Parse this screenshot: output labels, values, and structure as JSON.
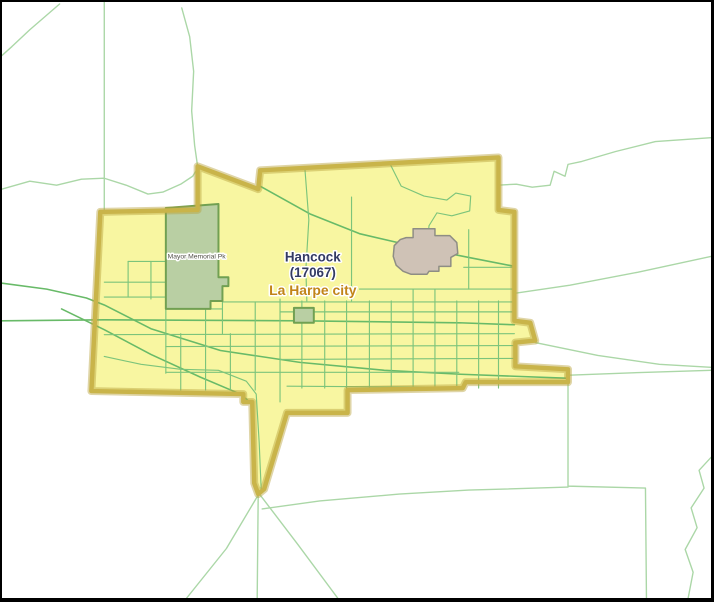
{
  "window": {
    "width": 714,
    "height": 602,
    "frame_color": "#000000",
    "background_color": "#ffffff"
  },
  "map": {
    "colors": {
      "city_fill": "#f8f6a1",
      "city_border": "#c9b44a",
      "city_border_glow": "#b7a13c",
      "rural_road": "#abd7a7",
      "major_road": "#68ba68",
      "city_street": "#7cc47b",
      "park_fill": "#b9cfa3",
      "park_stroke": "#71a052",
      "landmark_fill": "#cfc2b6",
      "landmark_stroke": "#8e8d84"
    },
    "city_boundary": {
      "name": "la-harpe-city-boundary",
      "stroke_width": 4.5,
      "glow_width": 8,
      "points": [
        [
          197,
          166
        ],
        [
          258,
          189
        ],
        [
          260,
          170
        ],
        [
          500,
          157
        ],
        [
          500,
          210
        ],
        [
          516,
          212
        ],
        [
          516,
          322
        ],
        [
          532,
          324
        ],
        [
          537,
          342
        ],
        [
          517,
          344
        ],
        [
          517,
          368
        ],
        [
          570,
          371
        ],
        [
          570,
          384
        ],
        [
          467,
          384
        ],
        [
          464,
          390
        ],
        [
          348,
          392
        ],
        [
          348,
          415
        ],
        [
          287,
          415
        ],
        [
          264,
          492
        ],
        [
          258,
          497
        ],
        [
          254,
          486
        ],
        [
          252,
          404
        ],
        [
          243,
          404
        ],
        [
          243,
          396
        ],
        [
          90,
          393
        ],
        [
          99,
          212
        ],
        [
          197,
          210
        ]
      ]
    },
    "parks": [
      {
        "name": "mayor-memorial-park",
        "points": [
          [
            165,
            208
          ],
          [
            218,
            204
          ],
          [
            218,
            278
          ],
          [
            228,
            278
          ],
          [
            228,
            287
          ],
          [
            222,
            287
          ],
          [
            222,
            302
          ],
          [
            210,
            302
          ],
          [
            210,
            310
          ],
          [
            165,
            310
          ]
        ]
      },
      {
        "name": "small-park",
        "points": [
          [
            294,
            309
          ],
          [
            314,
            309
          ],
          [
            314,
            324
          ],
          [
            294,
            324
          ]
        ]
      }
    ],
    "landmark": {
      "name": "landmark-area",
      "points": [
        [
          407,
          238
        ],
        [
          414,
          238
        ],
        [
          414,
          229
        ],
        [
          436,
          229
        ],
        [
          436,
          236
        ],
        [
          451,
          236
        ],
        [
          458,
          243
        ],
        [
          459,
          254
        ],
        [
          452,
          258
        ],
        [
          452,
          267
        ],
        [
          440,
          267
        ],
        [
          440,
          272
        ],
        [
          430,
          272
        ],
        [
          428,
          275
        ],
        [
          412,
          275
        ],
        [
          404,
          272
        ],
        [
          397,
          266
        ],
        [
          394,
          257
        ],
        [
          395,
          246
        ],
        [
          401,
          240
        ]
      ]
    },
    "rural_roads": {
      "width": 1.4,
      "lines": [
        [
          [
            103,
            0
          ],
          [
            103,
            211
          ]
        ],
        [
          [
            58,
            2
          ],
          [
            28,
            28
          ],
          [
            10,
            45
          ],
          [
            0,
            54
          ]
        ],
        [
          [
            181,
            6
          ],
          [
            189,
            35
          ],
          [
            193,
            70
          ],
          [
            191,
            110
          ],
          [
            194,
            145
          ],
          [
            197,
            166
          ]
        ],
        [
          [
            0,
            189
          ],
          [
            28,
            181
          ],
          [
            55,
            185
          ],
          [
            80,
            179
          ],
          [
            103,
            178
          ],
          [
            125,
            185
          ],
          [
            147,
            194
          ],
          [
            162,
            192
          ],
          [
            180,
            184
          ],
          [
            192,
            176
          ],
          [
            197,
            168
          ]
        ],
        [
          [
            714,
            137
          ],
          [
            658,
            141
          ],
          [
            618,
            151
          ],
          [
            584,
            161
          ],
          [
            570,
            164
          ],
          [
            567,
            176
          ],
          [
            556,
            171
          ],
          [
            552,
            185
          ],
          [
            534,
            187
          ],
          [
            518,
            184
          ],
          [
            499,
            185
          ]
        ],
        [
          [
            714,
            257
          ],
          [
            640,
            273
          ],
          [
            572,
            286
          ],
          [
            518,
            294
          ]
        ],
        [
          [
            537,
            344
          ],
          [
            600,
            357
          ],
          [
            662,
            366
          ],
          [
            714,
            369
          ]
        ],
        [
          [
            571,
            377
          ],
          [
            650,
            374
          ],
          [
            714,
            372
          ]
        ],
        [
          [
            570,
            385
          ],
          [
            570,
            489
          ],
          [
            648,
            491
          ],
          [
            649,
            602
          ]
        ],
        [
          [
            262,
            512
          ],
          [
            320,
            504
          ],
          [
            400,
            497
          ],
          [
            470,
            493
          ],
          [
            570,
            490
          ]
        ],
        [
          [
            714,
            460
          ],
          [
            702,
            473
          ],
          [
            707,
            491
          ],
          [
            694,
            511
          ],
          [
            700,
            531
          ],
          [
            688,
            553
          ],
          [
            696,
            576
          ],
          [
            691,
            602
          ]
        ],
        [
          [
            258,
            498
          ],
          [
            257,
            602
          ]
        ],
        [
          [
            258,
            498
          ],
          [
            226,
            552
          ],
          [
            186,
            602
          ]
        ],
        [
          [
            260,
            498
          ],
          [
            298,
            548
          ],
          [
            338,
            602
          ]
        ]
      ]
    },
    "major_roads": {
      "width": 1.6,
      "lines": [
        [
          [
            0,
            322
          ],
          [
            103,
            321
          ],
          [
            300,
            322
          ],
          [
            460,
            324
          ],
          [
            516,
            326
          ]
        ],
        [
          [
            0,
            284
          ],
          [
            45,
            290
          ],
          [
            85,
            299
          ],
          [
            103,
            306
          ],
          [
            150,
            330
          ],
          [
            220,
            352
          ],
          [
            300,
            364
          ],
          [
            385,
            372
          ],
          [
            462,
            376
          ],
          [
            516,
            378
          ],
          [
            568,
            380
          ]
        ],
        [
          [
            60,
            310
          ],
          [
            103,
            331
          ],
          [
            150,
            356
          ],
          [
            200,
            379
          ],
          [
            240,
            396
          ],
          [
            252,
            406
          ]
        ],
        [
          [
            260,
            186
          ],
          [
            310,
            214
          ],
          [
            360,
            234
          ],
          [
            420,
            248
          ],
          [
            470,
            258
          ],
          [
            516,
            267
          ]
        ]
      ]
    },
    "city_streets": {
      "width": 1.15,
      "lines": [
        [
          [
            103,
            358
          ],
          [
            140,
            366
          ],
          [
            180,
            371
          ],
          [
            218,
            372
          ],
          [
            246,
            383
          ],
          [
            256,
            396
          ],
          [
            259,
            445
          ],
          [
            261,
            492
          ]
        ],
        [
          [
            222,
            303
          ],
          [
            516,
            303
          ]
        ],
        [
          [
            280,
            313
          ],
          [
            516,
            313
          ]
        ],
        [
          [
            103,
            336
          ],
          [
            516,
            335
          ]
        ],
        [
          [
            165,
            348
          ],
          [
            516,
            347
          ]
        ],
        [
          [
            280,
            361
          ],
          [
            516,
            360
          ]
        ],
        [
          [
            165,
            374
          ],
          [
            460,
            374
          ]
        ],
        [
          [
            287,
            388
          ],
          [
            435,
            389
          ]
        ],
        [
          [
            360,
            290
          ],
          [
            516,
            290
          ]
        ],
        [
          [
            465,
            268
          ],
          [
            516,
            268
          ]
        ],
        [
          [
            470,
            230
          ],
          [
            470,
            290
          ]
        ],
        [
          [
            305,
            168
          ],
          [
            309,
            220
          ],
          [
            306,
            270
          ],
          [
            307,
            302
          ]
        ],
        [
          [
            352,
            197
          ],
          [
            352,
            302
          ]
        ],
        [
          [
            390,
            162
          ],
          [
            402,
            186
          ],
          [
            425,
            196
          ],
          [
            448,
            200
          ],
          [
            457,
            193
          ],
          [
            472,
            196
          ],
          [
            471,
            211
          ],
          [
            453,
            216
          ],
          [
            438,
            213
          ],
          [
            430,
            226
          ],
          [
            428,
            250
          ],
          [
            430,
            268
          ]
        ],
        [
          [
            205,
            303
          ],
          [
            205,
            392
          ]
        ],
        [
          [
            230,
            335
          ],
          [
            230,
            392
          ]
        ],
        [
          [
            255,
            303
          ],
          [
            255,
            392
          ]
        ],
        [
          [
            280,
            300
          ],
          [
            280,
            404
          ]
        ],
        [
          [
            302,
            302
          ],
          [
            302,
            390
          ]
        ],
        [
          [
            325,
            302
          ],
          [
            325,
            390
          ]
        ],
        [
          [
            347,
            302
          ],
          [
            347,
            392
          ]
        ],
        [
          [
            370,
            302
          ],
          [
            370,
            390
          ]
        ],
        [
          [
            392,
            302
          ],
          [
            392,
            390
          ]
        ],
        [
          [
            414,
            290
          ],
          [
            414,
            390
          ]
        ],
        [
          [
            436,
            290
          ],
          [
            436,
            390
          ]
        ],
        [
          [
            458,
            302
          ],
          [
            458,
            390
          ]
        ],
        [
          [
            480,
            302
          ],
          [
            480,
            390
          ]
        ],
        [
          [
            500,
            302
          ],
          [
            500,
            390
          ]
        ],
        [
          [
            165,
            310
          ],
          [
            165,
            375
          ]
        ],
        [
          [
            180,
            335
          ],
          [
            180,
            392
          ]
        ],
        [
          [
            127,
            262
          ],
          [
            165,
            262
          ]
        ],
        [
          [
            127,
            262
          ],
          [
            127,
            298
          ]
        ],
        [
          [
            150,
            262
          ],
          [
            150,
            300
          ]
        ],
        [
          [
            103,
            283
          ],
          [
            165,
            283
          ]
        ],
        [
          [
            103,
            298
          ],
          [
            165,
            298
          ]
        ],
        [
          [
            165,
            310
          ],
          [
            222,
            310
          ]
        ],
        [
          [
            222,
            287
          ],
          [
            222,
            335
          ]
        ]
      ]
    },
    "labels": [
      {
        "name": "place-label-hancock",
        "text": "Hancock",
        "x": 313,
        "y": 262,
        "size": 13.5,
        "weight": 600,
        "color": "#333a63"
      },
      {
        "name": "place-label-hancock-code",
        "text": "(17067)",
        "x": 313,
        "y": 278,
        "size": 13.5,
        "weight": 600,
        "color": "#333a63"
      },
      {
        "name": "place-label-laharpe",
        "text": "La Harpe city",
        "x": 313,
        "y": 296,
        "size": 14,
        "weight": 700,
        "color": "#c18418"
      },
      {
        "name": "park-label-mayor-memorial",
        "text": "Mayor Memorial Pk",
        "x": 196,
        "y": 259,
        "size": 6.8,
        "weight": 400,
        "color": "#4f4e45"
      }
    ]
  }
}
